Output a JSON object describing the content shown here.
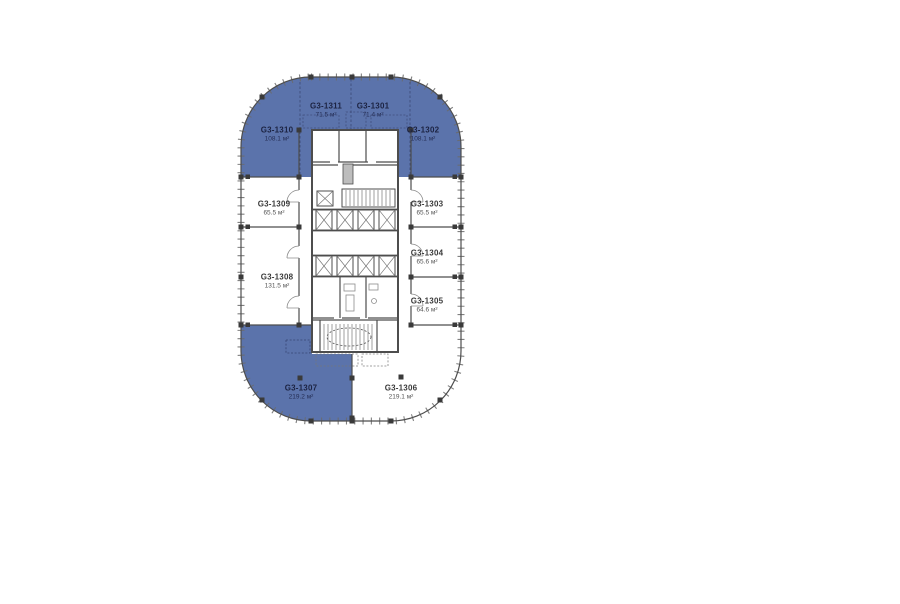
{
  "plan": {
    "colors": {
      "highlight": "#5b73ab",
      "wall": "#4d4d4d",
      "label_dark": "#3b3b3b",
      "label_on_highlight": "#1c2342"
    },
    "rooms": [
      {
        "id": "G3-1301",
        "area": "71.4 м²",
        "highlighted": true
      },
      {
        "id": "G3-1302",
        "area": "108.1 м²",
        "highlighted": true
      },
      {
        "id": "G3-1303",
        "area": "65.5 м²",
        "highlighted": false
      },
      {
        "id": "G3-1304",
        "area": "65.6 м²",
        "highlighted": false
      },
      {
        "id": "G3-1305",
        "area": "64.6 м²",
        "highlighted": false
      },
      {
        "id": "G3-1306",
        "area": "219.1 м²",
        "highlighted": false
      },
      {
        "id": "G3-1307",
        "area": "219.2 м²",
        "highlighted": true
      },
      {
        "id": "G3-1308",
        "area": "131.5 м²",
        "highlighted": false
      },
      {
        "id": "G3-1309",
        "area": "65.5 м²",
        "highlighted": false
      },
      {
        "id": "G3-1310",
        "area": "108.1 м²",
        "highlighted": true
      },
      {
        "id": "G3-1311",
        "area": "71.5 м²",
        "highlighted": true
      }
    ]
  }
}
